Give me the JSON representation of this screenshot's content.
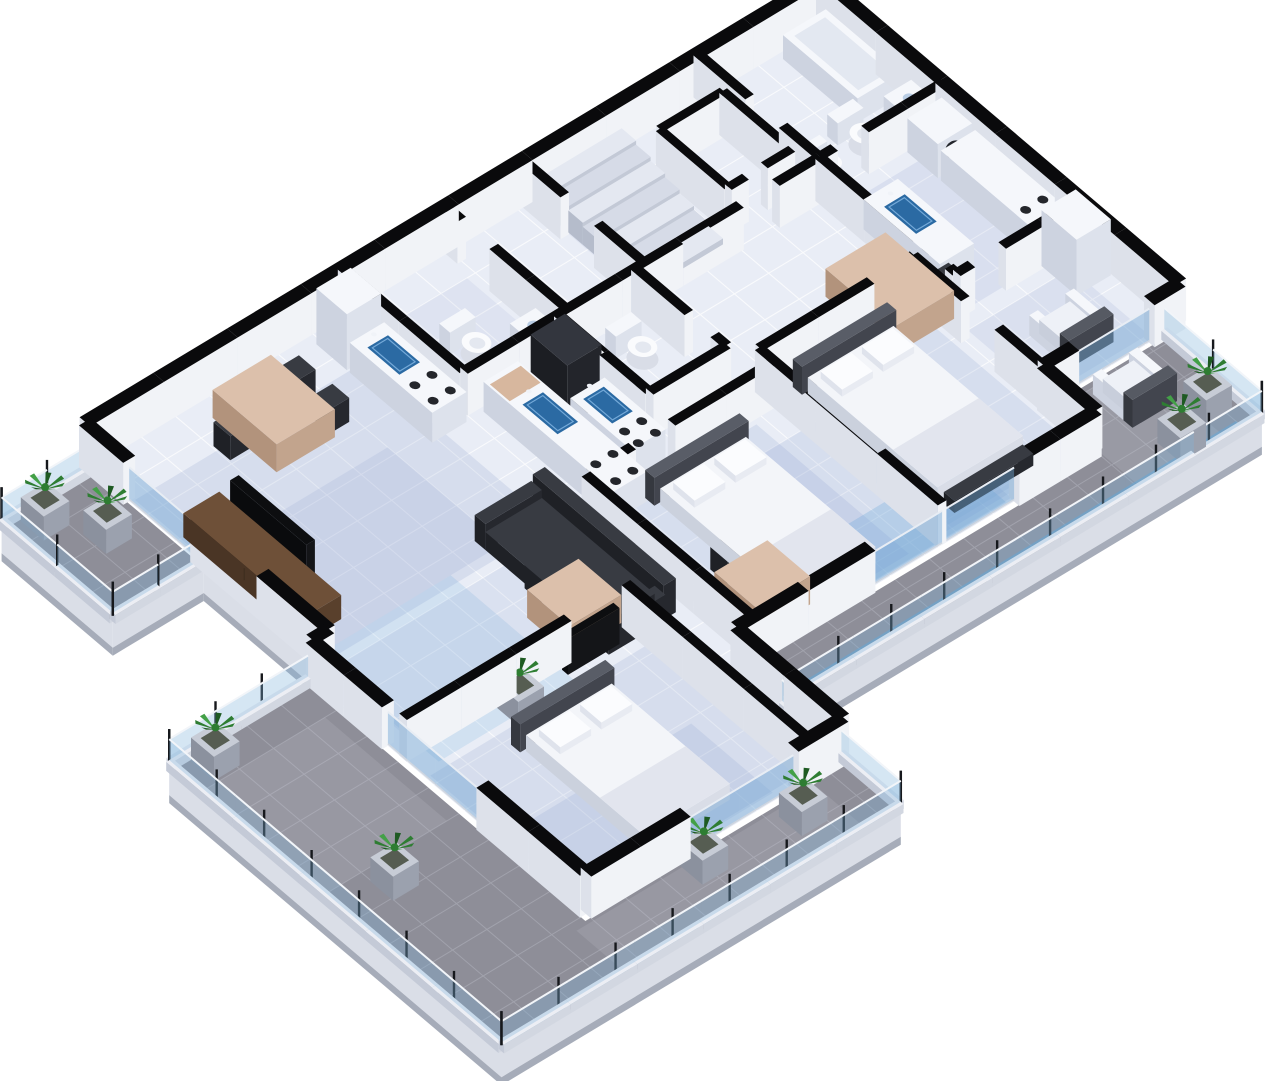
{
  "meta": {
    "image_type": "isometric-3d-floor-plan-render",
    "background": "#ffffff"
  },
  "rooms_visible": [
    "staircase-core",
    "elevator-shaft",
    "bathroom-with-bathtub",
    "kitchen-right",
    "living-dining-right",
    "bedroom-right",
    "bathroom-center",
    "kitchen-center",
    "bedroom-center",
    "living-dining-left",
    "kitchen-left",
    "bathroom-left",
    "bedroom-wing",
    "terrace-decks-with-planters"
  ],
  "palette": {
    "background": "#ffffff",
    "wall_top": "#0a0a0c",
    "wall_face_se": "#f1f3f7",
    "wall_face_sw": "#dde1ea",
    "floor": "#e9edf6",
    "floor_grid": "#ffffff",
    "shadow_blue": "#7d93c9",
    "shadow_cyan": "#58a0d8",
    "deck": "#8e8e98",
    "deck_grid": "#b0b3bd",
    "deck_patch": "#c6c9d3",
    "deck_fascia": "#dadee7",
    "deck_fascia2": "#a6acb9",
    "rail_base_top": "#eceef4",
    "rail_glass": "#7db0db",
    "post": "#16181c",
    "accent_cyan": "#54a3da",
    "white_top": "#f5f7fb",
    "white_se": "#dde2ec",
    "white_sw": "#cdd3e0",
    "dark_top": "#383b42",
    "dark_se": "#26282e",
    "dark_sw": "#1f2126",
    "wood_top": "#6e5038",
    "wood_se": "#59402c",
    "wood_sw": "#4a3525",
    "tan_top": "#dcc0ab",
    "tan_se": "#c2a48d",
    "tan_sw": "#b2937c",
    "sink": "#2b6aa3",
    "sink_rim": "#74a9d8",
    "mattress": "#f3f5f9",
    "headboard": "#595d67",
    "green1": "#2e7d32",
    "green2": "#43a047",
    "green3": "#1e5a22"
  },
  "scene": {
    "projection": {
      "origin": [
        822,
        20
      ],
      "a_axis": [
        -0.857,
        0.516
      ],
      "b_axis": [
        0.762,
        0.647
      ]
    },
    "wall_height": 42,
    "ext_thickness": 14,
    "int_thickness": 10,
    "floors": [
      {
        "name": "interior-floor",
        "pts": [
          [
            0,
            0
          ],
          [
            860,
            0
          ],
          [
            860,
            320
          ],
          [
            880,
            320
          ],
          [
            880,
            680
          ],
          [
            580,
            680
          ],
          [
            580,
            540
          ],
          [
            160,
            540
          ],
          [
            160,
            470
          ],
          [
            0,
            470
          ]
        ]
      }
    ],
    "decks": [
      {
        "name": "deck-upper-left",
        "pts": [
          [
            862,
            12
          ],
          [
            968,
            12
          ],
          [
            968,
            158
          ],
          [
            862,
            158
          ]
        ]
      },
      {
        "name": "deck-wing",
        "pts": [
          [
            886,
            322
          ],
          [
            1048,
            322
          ],
          [
            1048,
            758
          ],
          [
            582,
            758
          ],
          [
            582,
            686
          ],
          [
            886,
            686
          ]
        ]
      },
      {
        "name": "deck-south",
        "pts": [
          [
            22,
            474
          ],
          [
            160,
            474
          ],
          [
            160,
            546
          ],
          [
            578,
            546
          ],
          [
            578,
            602
          ],
          [
            22,
            602
          ]
        ]
      }
    ],
    "fascia_edges": [
      [
        968,
        12,
        968,
        158
      ],
      [
        968,
        158,
        862,
        158
      ],
      [
        862,
        158,
        862,
        322
      ],
      [
        1048,
        322,
        1048,
        758
      ],
      [
        1048,
        758,
        582,
        758
      ],
      [
        578,
        602,
        22,
        602
      ]
    ],
    "ext_walls": [
      [
        0,
        0,
        860,
        0
      ],
      [
        0,
        0,
        0,
        470
      ],
      [
        860,
        0,
        860,
        58
      ],
      [
        860,
        146,
        860,
        320
      ],
      [
        860,
        320,
        880,
        320
      ],
      [
        880,
        320,
        880,
        420
      ],
      [
        880,
        544,
        880,
        680
      ],
      [
        880,
        680,
        764,
        680
      ],
      [
        638,
        680,
        580,
        680
      ],
      [
        580,
        680,
        580,
        540
      ],
      [
        580,
        540,
        424,
        540
      ],
      [
        256,
        540,
        160,
        540
      ],
      [
        160,
        540,
        160,
        470
      ],
      [
        160,
        470,
        124,
        470
      ],
      [
        36,
        470,
        0,
        470
      ]
    ],
    "int_walls": [
      [
        145,
        0,
        145,
        68
      ],
      [
        145,
        112,
        145,
        160
      ],
      [
        350,
        0,
        350,
        56
      ],
      [
        350,
        100,
        350,
        160
      ],
      [
        145,
        160,
        196,
        160
      ],
      [
        238,
        160,
        450,
        160
      ],
      [
        0,
        160,
        92,
        160
      ],
      [
        128,
        160,
        145,
        160
      ],
      [
        0,
        340,
        92,
        340
      ],
      [
        128,
        340,
        145,
        340
      ],
      [
        145,
        160,
        145,
        288
      ],
      [
        145,
        330,
        145,
        340
      ],
      [
        160,
        300,
        170,
        300
      ],
      [
        210,
        300,
        340,
        300
      ],
      [
        160,
        300,
        160,
        368
      ],
      [
        160,
        412,
        160,
        470
      ],
      [
        340,
        300,
        340,
        540
      ],
      [
        360,
        160,
        360,
        230
      ],
      [
        360,
        264,
        360,
        280
      ],
      [
        360,
        280,
        450,
        280
      ],
      [
        450,
        160,
        450,
        280
      ],
      [
        340,
        320,
        460,
        320
      ],
      [
        506,
        320,
        560,
        320
      ],
      [
        560,
        320,
        560,
        540
      ],
      [
        440,
        0,
        440,
        22
      ],
      [
        440,
        64,
        440,
        160
      ],
      [
        440,
        160,
        560,
        160
      ],
      [
        560,
        0,
        560,
        160
      ],
      [
        620,
        440,
        646,
        440
      ],
      [
        688,
        440,
        880,
        440
      ],
      [
        620,
        440,
        620,
        680
      ]
    ],
    "elevator_walls": [
      [
        158,
        48,
        232,
        48
      ],
      [
        158,
        48,
        158,
        138
      ],
      [
        232,
        48,
        232,
        138
      ],
      [
        158,
        138,
        190,
        138
      ],
      [
        212,
        138,
        232,
        138
      ]
    ],
    "glass_doors": [
      [
        36,
        470,
        124,
        470
      ],
      [
        256,
        540,
        424,
        540
      ],
      [
        638,
        680,
        764,
        680
      ],
      [
        880,
        420,
        880,
        544
      ],
      [
        860,
        58,
        860,
        146
      ]
    ],
    "stairs": {
      "rect": [
        248,
        16,
        344,
        16
      ],
      "steps": 7,
      "depth": 19,
      "h0": 30,
      "dh": 4
    },
    "railings": [
      [
        968,
        12,
        968,
        158
      ],
      [
        862,
        158,
        968,
        158
      ],
      [
        862,
        12,
        968,
        12
      ],
      [
        1048,
        322,
        1048,
        758
      ],
      [
        582,
        758,
        1048,
        758
      ],
      [
        886,
        322,
        1048,
        322
      ],
      [
        582,
        602,
        582,
        758
      ],
      [
        22,
        602,
        578,
        602
      ],
      [
        22,
        474,
        22,
        602
      ]
    ],
    "post_spacing": 64,
    "shadows": [
      {
        "r": [
          590,
          60,
          855,
          310
        ],
        "c": "blue",
        "o": 0.18
      },
      {
        "r": [
          640,
          150,
          855,
          300
        ],
        "c": "blue",
        "o": 0.15
      },
      {
        "r": [
          700,
          300,
          858,
          462
        ],
        "c": "cyan",
        "o": 0.16
      },
      {
        "r": [
          20,
          180,
          140,
          340
        ],
        "c": "blue",
        "o": 0.15
      },
      {
        "r": [
          170,
          330,
          335,
          530
        ],
        "c": "blue",
        "o": 0.17
      },
      {
        "r": [
          215,
          405,
          335,
          525
        ],
        "c": "blue",
        "o": 0.15
      },
      {
        "r": [
          370,
          330,
          555,
          530
        ],
        "c": "blue",
        "o": 0.17
      },
      {
        "r": [
          255,
          360,
          470,
          535
        ],
        "c": "blue",
        "o": 0.17
      },
      {
        "r": [
          262,
          470,
          430,
          536
        ],
        "c": "cyan",
        "o": 0.25
      },
      {
        "r": [
          590,
          470,
          875,
          670
        ],
        "c": "blue",
        "o": 0.18
      },
      {
        "r": [
          655,
          565,
          870,
          672
        ],
        "c": "blue",
        "o": 0.16
      },
      {
        "r": [
          250,
          20,
          345,
          150
        ],
        "c": "blue",
        "o": 0.1
      },
      {
        "r": [
          450,
          40,
          560,
          150
        ],
        "c": "blue",
        "o": 0.1
      },
      {
        "r": [
          30,
          360,
          150,
          462
        ],
        "c": "blue",
        "o": 0.14
      },
      {
        "r": [
          600,
          320,
          860,
          430
        ],
        "c": "blue",
        "o": 0.13
      }
    ],
    "deck_patches": [
      {
        "r": [
          60,
          480,
          158,
          598
        ],
        "o": 0.22
      },
      {
        "r": [
          900,
          360,
          1040,
          520
        ],
        "o": 0.18
      },
      {
        "r": [
          620,
          690,
          900,
          750
        ],
        "o": 0.18
      }
    ],
    "streaks": [
      [
        40,
        588,
        560,
        596
      ],
      [
        1038,
        340,
        1044,
        748
      ],
      [
        600,
        748,
        1040,
        754
      ],
      [
        958,
        20,
        964,
        150
      ]
    ],
    "furniture": [
      {
        "k": "bathtub",
        "r": [
          8,
          14,
          58,
          112
        ]
      },
      {
        "k": "toilet",
        "c": [
          75,
          140
        ]
      },
      {
        "k": "bidet",
        "c": [
          118,
          144
        ]
      },
      {
        "k": "basin",
        "r": [
          8,
          126,
          40,
          158
        ]
      },
      {
        "k": "washer",
        "r": [
          8,
          166,
          48,
          206
        ]
      },
      {
        "k": "counter",
        "r": [
          8,
          210,
          48,
          338
        ],
        "burners": [
          [
            18,
            310
          ],
          [
            38,
            310
          ],
          [
            18,
            332
          ],
          [
            38,
            332
          ]
        ]
      },
      {
        "k": "tallcab",
        "r": [
          8,
          342,
          48,
          388
        ]
      },
      {
        "k": "counter",
        "r": [
          100,
          212,
          140,
          312
        ],
        "sink": [
          108,
          230,
          132,
          272
        ]
      },
      {
        "k": "table",
        "r": [
          150,
          252,
          220,
          342
        ]
      },
      {
        "k": "chair",
        "r": [
          128,
          262,
          150,
          284
        ]
      },
      {
        "k": "chair",
        "r": [
          128,
          310,
          150,
          332
        ]
      },
      {
        "k": "chair",
        "r": [
          220,
          284,
          242,
          306
        ]
      },
      {
        "k": "armchair",
        "r": [
          60,
          398,
          112,
          450
        ]
      },
      {
        "k": "armchair",
        "r": [
          64,
          486,
          116,
          538
        ]
      },
      {
        "k": "bed",
        "m": [
          210,
          330,
          310,
          500
        ]
      },
      {
        "k": "bench",
        "r": [
          214,
          504,
          306,
          518
        ]
      },
      {
        "k": "toilet",
        "c": [
          398,
          212
        ]
      },
      {
        "k": "bidet",
        "c": [
          440,
          214
        ]
      },
      {
        "k": "counter",
        "r": [
          506,
          170,
          546,
          340
        ],
        "board": [
          506,
          176,
          546,
          202
        ],
        "sink": [
          514,
          212,
          538,
          258
        ],
        "burners": [
          [
            516,
            306
          ],
          [
            536,
            306
          ],
          [
            516,
            332
          ],
          [
            536,
            332
          ]
        ]
      },
      {
        "k": "counter",
        "r": [
          460,
          232,
          500,
          312
        ],
        "sink": [
          468,
          240,
          492,
          278
        ],
        "burners": [
          [
            470,
            292
          ],
          [
            490,
            292
          ],
          [
            470,
            310
          ],
          [
            490,
            310
          ]
        ]
      },
      {
        "k": "fridge",
        "r": [
          460,
          180,
          500,
          228
        ]
      },
      {
        "k": "bed",
        "m": [
          400,
          350,
          500,
          520
        ]
      },
      {
        "k": "desk",
        "r": [
          478,
          466,
          540,
          522
        ]
      },
      {
        "k": "chair",
        "r": [
          494,
          436,
          518,
          458
        ]
      },
      {
        "k": "sideboard",
        "r": [
          810,
          120,
          852,
          280
        ]
      },
      {
        "k": "tv",
        "r": [
          814,
          150,
          824,
          250
        ]
      },
      {
        "k": "table",
        "r": [
          668,
          28,
          736,
          112
        ]
      },
      {
        "k": "chair",
        "r": [
          646,
          40,
          668,
          62
        ]
      },
      {
        "k": "chair",
        "r": [
          646,
          84,
          668,
          106
        ]
      },
      {
        "k": "chair",
        "r": [
          736,
          54,
          758,
          76
        ]
      },
      {
        "k": "sofa",
        "seat": [
          590,
          290,
          656,
          450
        ]
      },
      {
        "k": "counter",
        "r": [
          566,
          62,
          606,
          170
        ],
        "sink": [
          574,
          76,
          598,
          118
        ],
        "burners": [
          [
            576,
            136
          ],
          [
            596,
            136
          ],
          [
            576,
            160
          ],
          [
            596,
            160
          ]
        ]
      },
      {
        "k": "tallcab",
        "r": [
          566,
          18,
          606,
          58
        ]
      },
      {
        "k": "shower",
        "r": [
          526,
          12,
          558,
          70
        ]
      },
      {
        "k": "toilet",
        "c": [
          508,
          118
        ]
      },
      {
        "k": "basin",
        "r": [
          448,
          128,
          478,
          158
        ]
      },
      {
        "k": "bed",
        "m": [
          690,
          500,
          790,
          655
        ]
      },
      {
        "k": "tvpanel",
        "r": [
          640,
          446,
          700,
          454
        ]
      },
      {
        "k": "desk",
        "r": [
          622,
          380,
          682,
          436
        ]
      },
      {
        "k": "chair",
        "r": [
          636,
          352,
          660,
          374
        ]
      }
    ],
    "plants": [
      [
        935,
        32
      ],
      [
        903,
        78
      ],
      [
        1012,
        342
      ],
      [
        986,
        548
      ],
      [
        762,
        702
      ],
      [
        655,
        712
      ],
      [
        48,
        560
      ],
      [
        96,
        580
      ],
      [
        760,
        458
      ]
    ]
  }
}
